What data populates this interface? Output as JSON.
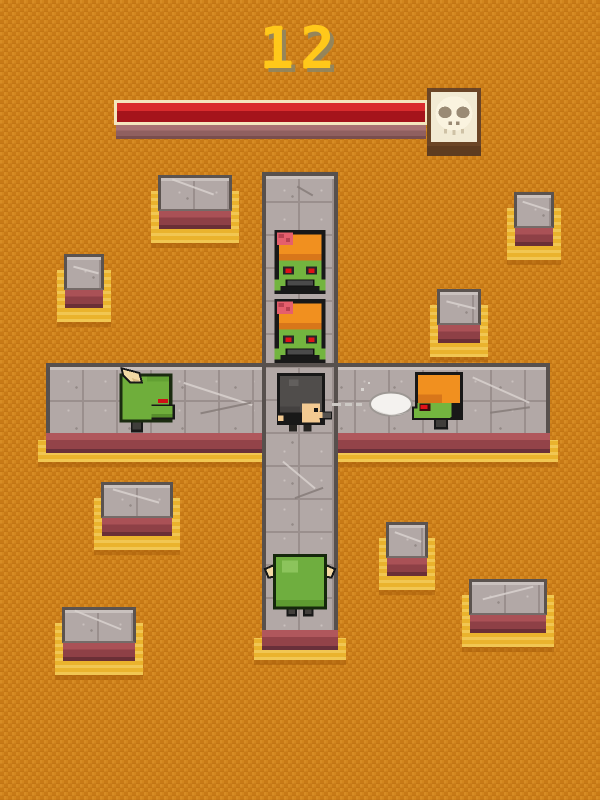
{
  "hud": {
    "score": "12",
    "health_bar": {
      "fill_percent": 100,
      "fill_color": "#c21e25",
      "frame_color": "#f4e6be",
      "base_color": "#a87272"
    },
    "skull_icon": "skull"
  },
  "background": {
    "base_color": "#d2861e",
    "weave_color": "#c87a16",
    "pattern": "zigzag-weave"
  },
  "board": {
    "paths": [
      {
        "name": "vertical-corridor",
        "tile_color": "#b2a8a6",
        "edge_color": "#57504d"
      },
      {
        "name": "horizontal-corridor",
        "tile_color": "#b2a8a6",
        "edge_color": "#57504d"
      }
    ],
    "stone_block_count": 8,
    "block_top_color": "#b2a8a6",
    "block_side_color": "#aa5156",
    "glow_color": "#eab32d"
  },
  "entities": {
    "player": {
      "type": "hero",
      "facing": "right",
      "helmet_color": "#504d4b",
      "skin_color": "#f3ca92",
      "weapon": "gun"
    },
    "projectile": {
      "type": "bullet",
      "color": "#f4f2ef",
      "direction": "right"
    },
    "enemies": [
      {
        "type": "zombie-brain-exposed",
        "facing": "down",
        "hat_color": "#f1901f",
        "skin_color": "#73b53f",
        "eye_color": "#e01218"
      },
      {
        "type": "zombie-brain-exposed",
        "facing": "down",
        "hat_color": "#f1901f",
        "skin_color": "#73b53f",
        "eye_color": "#e01218"
      },
      {
        "type": "zombie-capped",
        "facing": "left",
        "hat_color": "#f1901f",
        "skin_color": "#73b53f",
        "eye_color": "#e01218"
      },
      {
        "type": "horned-orc",
        "facing": "right",
        "skin_color": "#6fae3b",
        "horn_color": "#f3d9a4",
        "eye_color": "#d01016"
      },
      {
        "type": "horned-brute",
        "facing": "up",
        "skin_color": "#6fae3f",
        "horn_color": "#f3d9a4"
      }
    ]
  }
}
